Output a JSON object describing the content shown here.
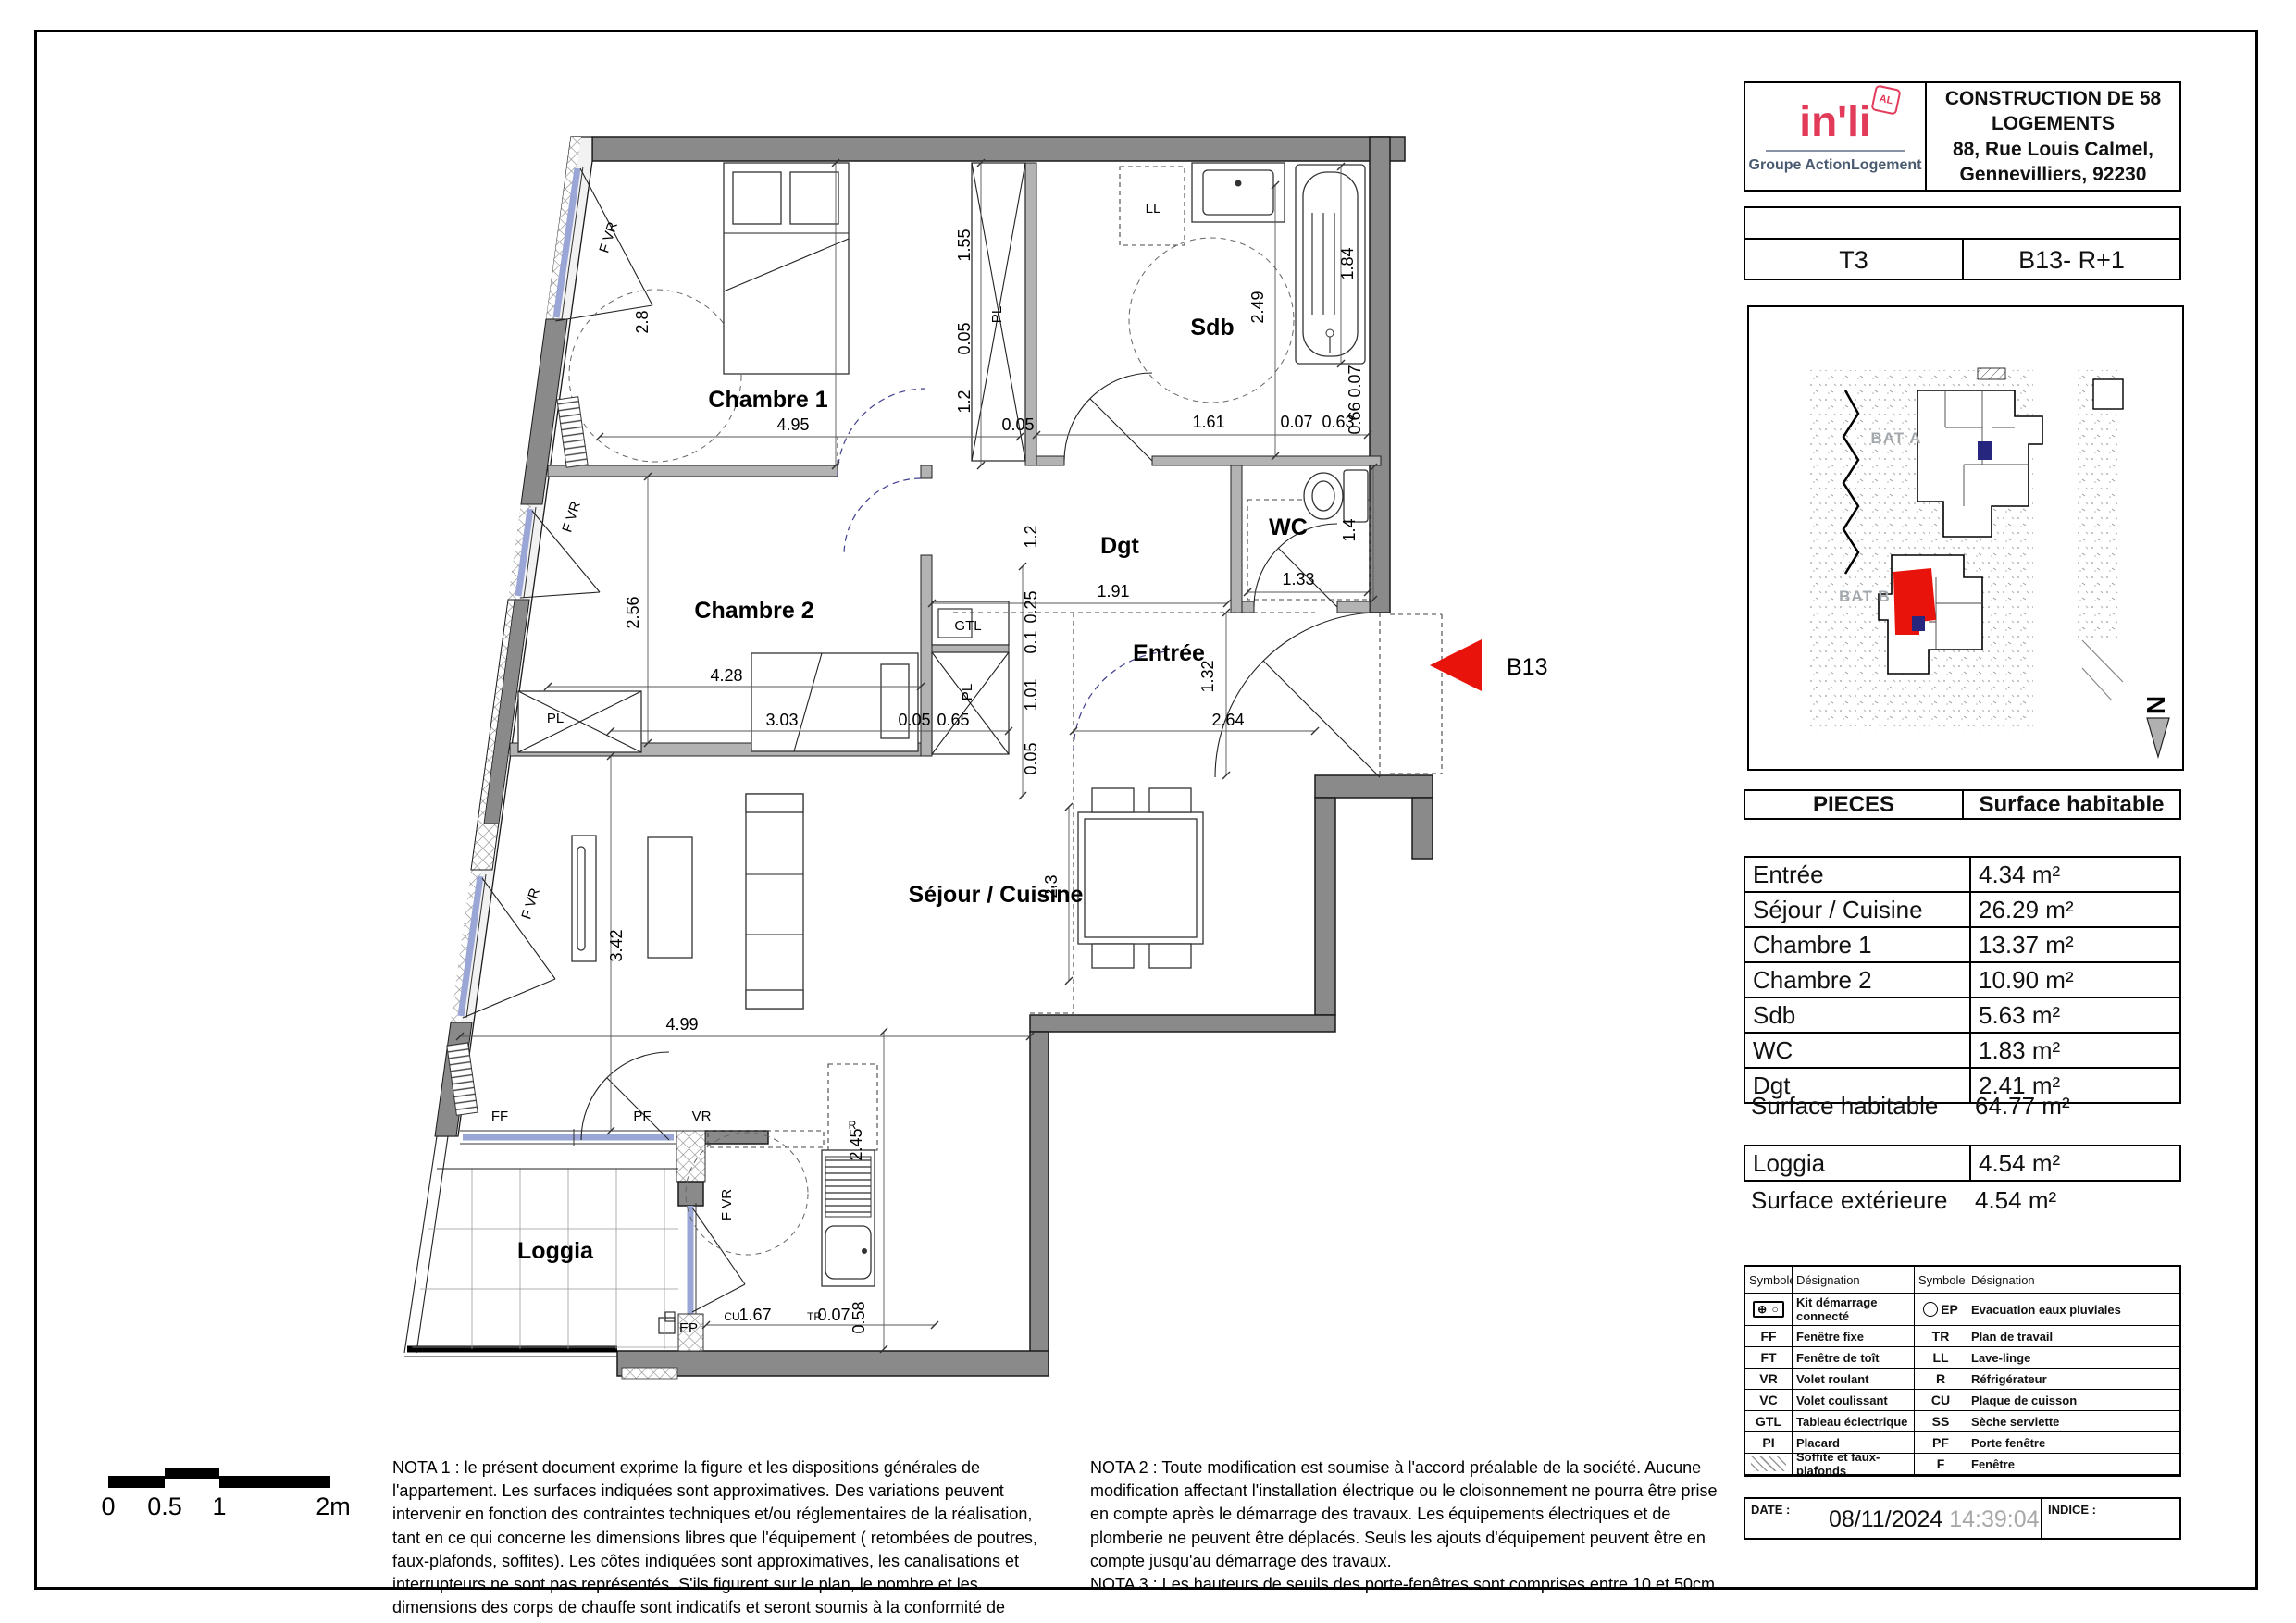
{
  "title_block": {
    "logo_brand": "in'li",
    "logo_badge": "AL",
    "logo_subtitle": "Groupe ActionLogement",
    "project_title": "CONSTRUCTION DE 58 LOGEMENTS",
    "address_line1": "88, Rue Louis Calmel,",
    "address_line2": "Gennevilliers, 92230"
  },
  "unit_block": {
    "type": "T3",
    "ref": "B13- R+1"
  },
  "site_map": {
    "bat_a": "BAT A",
    "bat_b": "BAT B",
    "north_letter": "N"
  },
  "surface_table": {
    "header": {
      "pieces": "PIECES",
      "surface": "Surface habitable"
    },
    "rows": [
      {
        "label": "Entrée",
        "value": "4.34 m²"
      },
      {
        "label": "Séjour / Cuisine",
        "value": "26.29 m²"
      },
      {
        "label": "Chambre 1",
        "value": "13.37 m²"
      },
      {
        "label": "Chambre 2",
        "value": "10.90 m²"
      },
      {
        "label": "Sdb",
        "value": "5.63 m²"
      },
      {
        "label": "WC",
        "value": "1.83 m²"
      },
      {
        "label": "Dgt",
        "value": "2.41 m²"
      }
    ],
    "total_label": "Surface habitable",
    "total_value": "64.77 m²",
    "loggia_label": "Loggia",
    "loggia_value": "4.54 m²",
    "exterior_label": "Surface extérieure",
    "exterior_value": "4.54 m²"
  },
  "legend": {
    "header_symbol": "Symbole",
    "header_designation": "Désignation",
    "rows": [
      {
        "s1": "⊕ ○",
        "d1": "Kit démarrage connecté",
        "s2": "EP",
        "d2": "Evacuation eaux pluviales"
      },
      {
        "s1": "FF",
        "d1": "Fenêtre fixe",
        "s2": "TR",
        "d2": "Plan de travail"
      },
      {
        "s1": "FT",
        "d1": "Fenêtre de toît",
        "s2": "LL",
        "d2": "Lave-linge"
      },
      {
        "s1": "VR",
        "d1": "Volet roulant",
        "s2": "R",
        "d2": "Réfrigérateur"
      },
      {
        "s1": "VC",
        "d1": "Volet coulissant",
        "s2": "CU",
        "d2": "Plaque de cuisson"
      },
      {
        "s1": "GTL",
        "d1": "Tableau éclectrique",
        "s2": "SS",
        "d2": "Sèche serviette"
      },
      {
        "s1": "PI",
        "d1": "Placard",
        "s2": "PF",
        "d2": "Porte fenêtre"
      },
      {
        "s1": "",
        "d1": "Soffite et faux-plafonds",
        "s2": "F",
        "d2": "Fenêtre"
      }
    ]
  },
  "footer": {
    "date_label": "DATE :",
    "date": "08/11/2024",
    "time": "14:39:04",
    "indice_label": "INDICE :"
  },
  "notes": {
    "nota1": "NOTA 1 : le présent document exprime la figure et les dispositions générales de l'appartement. Les surfaces indiquées sont approximatives. Des variations peuvent intervenir en fonction des contraintes techniques et/ou réglementaires de la réalisation, tant en ce qui concerne les dimensions libres que l'équipement ( retombées de poutres, faux-plafonds, soffites). Les côtes indiquées sont approximatives, les canalisations et interrupteurs ne sont pas représentés. S'ils figurent sur le plan, le nombre et les dimensions des corps de chauffe sont indicatifs et seront soumis à la conformité de l'étude thermique. Les quadrillages dessinés ne sont pas des calepinages. Les surfaces habitables sont conformes au décret du 23 mars 1997 (art.4.1).",
    "nota2": "NOTA 2 : Toute modification est soumise à l'accord préalable de la société. Aucune modification affectant l'installation électrique ou le cloisonnement ne pourra être prise en compte après le démarrage des travaux. Les équipements électriques et de plomberie ne peuvent être déplacés. Seuls les ajouts d'équipement peuvent être en compte jusqu'au démarrage des travaux.",
    "nota3": "NOTA 3 : Les hauteurs de seuils des porte-fenêtres sont comprises entre 10 et 50cm"
  },
  "scale_bar": {
    "t0": "0",
    "t1": "0.5",
    "t2": "1",
    "t3": "2m"
  },
  "plan": {
    "arrow_label": "B13",
    "rooms": [
      "Chambre 1",
      "Chambre 2",
      "Sdb",
      "WC",
      "Dgt",
      "Entrée",
      "Séjour / Cuisine",
      "Loggia"
    ],
    "dims": [
      "4.95",
      "0.05",
      "1.61",
      "0.07",
      "0.63",
      "1.91",
      "1.33",
      "2.64",
      "4.28",
      "3.03",
      "0.05",
      "0.65",
      "4.99",
      "1.67",
      "0.07",
      "2.8",
      "1.55",
      "0.05",
      "1.2",
      "2.49",
      "1.84",
      "0.07",
      "0.66",
      "1.4",
      "1.2",
      "0.25",
      "0.1",
      "1.01",
      "0.05",
      "1.32",
      "2.56",
      "3.42",
      "2.3",
      "2.45",
      "0.58"
    ],
    "small_labels": [
      "FF",
      "PF",
      "VR",
      "F VR",
      "F VR",
      "F VR",
      "F VR",
      "PL",
      "PL",
      "PL",
      "GTL",
      "LL",
      "R",
      "EP",
      "CU",
      "TR"
    ]
  },
  "colors": {
    "accent_red": "#e8140c",
    "logo_pink": "#e23b5a",
    "logo_slate": "#4a5a70",
    "wall_gray": "#8a8a8a",
    "window_blue": "#9aa6d6",
    "highlight_navy": "#26267e"
  }
}
